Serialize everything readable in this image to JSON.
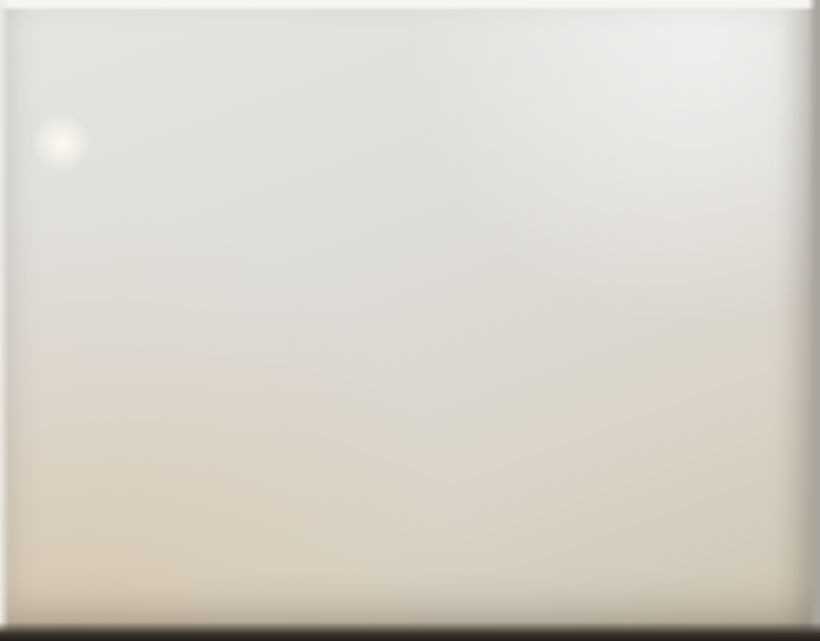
{
  "board": {
    "road_top": {
      "en": "Middle Jianguo Rd",
      "zh": [
        "建",
        "国",
        "中",
        "路"
      ]
    },
    "road_bottom": {
      "en": "Taikang Rd",
      "zh": [
        "泰",
        "康",
        "路"
      ]
    },
    "watermark": "Happy Achee上海 2015田子坊"
  },
  "compass": {
    "n": "北",
    "s": "南",
    "e": "东",
    "w": "西"
  },
  "colors": {
    "lane": "#e4daa2",
    "route_red": "#c42626",
    "route_green": "#2c7a33",
    "route_black": "#262622",
    "red_dot": "#c62222",
    "sign_blue": "#21359c",
    "fire_red": "#c0281e",
    "star_red": "#c41414"
  },
  "lane_labels": [
    {
      "text": "455号",
      "x": 128,
      "y": 162,
      "vertical": false,
      "rot": 9,
      "size": 10
    },
    {
      "text": "274弄",
      "x": 101,
      "y": 402,
      "vertical": true,
      "step_x": 3,
      "step_y": 16,
      "size": 13,
      "rot": 18
    },
    {
      "text": "248弄",
      "x": 306,
      "y": 410,
      "vertical": true,
      "step_x": 2,
      "step_y": 15,
      "size": 13,
      "rot": 15
    },
    {
      "text": "248弄",
      "x": 421,
      "y": 138,
      "vertical": true,
      "step_x": 2,
      "step_y": 11,
      "size": 9,
      "rot": 12
    },
    {
      "text": "210弄",
      "x": 578,
      "y": 414,
      "vertical": true,
      "step_x": 3,
      "step_y": 15,
      "size": 13,
      "rot": 15
    },
    {
      "text": "200号",
      "x": 760,
      "y": 422,
      "vertical": true,
      "step_x": 2,
      "step_y": 18,
      "size": 13,
      "rot": 10
    }
  ],
  "boards": {
    "gate": {
      "x": 536,
      "y": 487,
      "w": 62,
      "h": 16,
      "rot": -5,
      "text": "田子坊",
      "sub": "泰康路210弄"
    },
    "tianchengli": {
      "x": 266,
      "y": 506,
      "w": 56,
      "h": 15,
      "rot": -4,
      "text": "里成天"
    },
    "film": {
      "x": 413,
      "y": 300,
      "text": "FILM"
    },
    "bubble": {
      "x": 561,
      "y": 327,
      "w": 46,
      "h": 22,
      "line1": "田子坊",
      "line2": "服务中心"
    },
    "creative": {
      "x": 648,
      "y": 336,
      "text": "创意大楼"
    }
  },
  "small_labels": [
    {
      "x": 96,
      "y": 205,
      "text": "L4363"
    },
    {
      "x": 377,
      "y": 287,
      "text": "公共厕所"
    }
  ],
  "markers": {
    "star": {
      "x": 529,
      "y": 111
    },
    "info_sign": {
      "x": 608,
      "y": 506,
      "glyph": "i"
    },
    "first_aid": {
      "x": 636,
      "y": 506
    },
    "red_dots": [
      {
        "x": 266,
        "y": 58,
        "label": "建中居委办",
        "label_pos": "below"
      },
      {
        "x": 760,
        "y": 28,
        "label": "看板",
        "label_pos": "right"
      },
      {
        "x": 113,
        "y": 297,
        "label": "田子坊物业管理处",
        "label_pos": "below"
      },
      {
        "x": 710,
        "y": 207,
        "label": "消防站",
        "label_pos": "below"
      },
      {
        "x": 633,
        "y": 390,
        "label": "田子坊管理办",
        "label_pos": "below"
      },
      {
        "x": 662,
        "y": 472,
        "label": "田子坊管理办",
        "label_pos": "below"
      },
      {
        "x": 626,
        "y": 527,
        "label": "泰康路居委会",
        "label_pos": "below"
      }
    ],
    "fire_points": [
      [
        363,
        103
      ],
      [
        455,
        210
      ],
      [
        600,
        227
      ],
      [
        502,
        247
      ],
      [
        140,
        323
      ],
      [
        138,
        385
      ],
      [
        292,
        415
      ],
      [
        396,
        348
      ],
      [
        566,
        380
      ]
    ],
    "toilets": [
      {
        "x": 388,
        "y": 92,
        "type": "pair"
      },
      {
        "x": 396,
        "y": 127,
        "type": "pair"
      },
      {
        "x": 78,
        "y": 298,
        "type": "pair",
        "label": "(管理处内)"
      },
      {
        "x": 338,
        "y": 460,
        "type": "pair"
      },
      {
        "x": 373,
        "y": 268,
        "type": "pair"
      },
      {
        "x": 658,
        "y": 318,
        "type": "pair"
      },
      {
        "x": 156,
        "y": 355,
        "type": "man"
      },
      {
        "x": 675,
        "y": 228,
        "type": "man"
      }
    ],
    "arrow_signs": [
      {
        "x": 297,
        "y": 57,
        "dir": "up"
      },
      {
        "x": 713,
        "y": 30,
        "dir": "up"
      },
      {
        "x": 36,
        "y": 244,
        "dir": "left"
      },
      {
        "x": 46,
        "y": 562,
        "dir": "up"
      },
      {
        "x": 45,
        "y": 589,
        "dir": "down"
      },
      {
        "x": 272,
        "y": 566,
        "dir": "up-left"
      },
      {
        "x": 311,
        "y": 567,
        "dir": "down"
      },
      {
        "x": 547,
        "y": 552,
        "dir": "up"
      },
      {
        "x": 583,
        "y": 553,
        "dir": "down"
      }
    ]
  },
  "routes": [
    {
      "name": "red-route-jianguo",
      "color": "#c42626",
      "points": [
        [
          540,
          119
        ],
        [
          600,
          121
        ],
        [
          650,
          121
        ],
        [
          687,
          122
        ]
      ]
    },
    {
      "name": "red-route-main",
      "color": "#c42626",
      "points": [
        [
          687,
          122
        ],
        [
          670,
          200
        ],
        [
          650,
          280
        ],
        [
          628,
          360
        ],
        [
          605,
          440
        ],
        [
          585,
          500
        ],
        [
          568,
          543
        ]
      ]
    },
    {
      "name": "red-route-exit-north",
      "color": "#c42626",
      "points": [
        [
          690,
          115
        ],
        [
          697,
          85
        ]
      ],
      "arrow": {
        "x": 699,
        "y": 74,
        "angle": 10
      }
    },
    {
      "name": "red-route-inner",
      "color": "#c42626",
      "points": [
        [
          522,
          122
        ],
        [
          503,
          147
        ],
        [
          492,
          182
        ],
        [
          488,
          215
        ],
        [
          500,
          233
        ],
        [
          530,
          241
        ],
        [
          560,
          240
        ],
        [
          572,
          236
        ]
      ]
    },
    {
      "name": "green-route-455",
      "color": "#2c7a33",
      "points": [
        [
          46,
          168
        ],
        [
          78,
          173
        ],
        [
          110,
          187
        ],
        [
          142,
          199
        ],
        [
          174,
          211
        ],
        [
          206,
          224
        ],
        [
          238,
          236
        ],
        [
          268,
          246
        ],
        [
          296,
          254
        ],
        [
          312,
          258
        ]
      ]
    },
    {
      "name": "green-route-north",
      "color": "#2c7a33",
      "points": [
        [
          303,
          112
        ],
        [
          300,
          97
        ]
      ],
      "arrow": {
        "x": 298,
        "y": 88,
        "angle": -5
      }
    },
    {
      "name": "green-route-mid",
      "color": "#2c7a33",
      "points": [
        [
          147,
          374
        ],
        [
          142,
          356
        ]
      ],
      "arrow": {
        "x": 139,
        "y": 346,
        "angle": -10
      }
    },
    {
      "name": "green-route-taikang",
      "color": "#2c7a33",
      "points": [
        [
          61,
          587
        ],
        [
          57,
          570
        ],
        [
          61,
          558
        ]
      ],
      "arrow": {
        "x": 63,
        "y": 550,
        "angle": 8
      }
    },
    {
      "name": "black-route-248",
      "color": "#262622",
      "points": [
        [
          434,
          112
        ],
        [
          427,
          148
        ],
        [
          419,
          184
        ],
        [
          410,
          220
        ],
        [
          400,
          256
        ],
        [
          390,
          292
        ],
        [
          379,
          327
        ],
        [
          367,
          361
        ],
        [
          354,
          395
        ],
        [
          341,
          428
        ],
        [
          328,
          460
        ],
        [
          317,
          489
        ]
      ],
      "arrow": {
        "x": 436,
        "y": 99,
        "angle": -22
      }
    },
    {
      "name": "black-route-tianchengli",
      "color": "#262622",
      "points": [
        [
          299,
          574
        ],
        [
          298,
          558
        ]
      ],
      "arrow": {
        "x": 297,
        "y": 547,
        "angle": 0
      }
    }
  ]
}
